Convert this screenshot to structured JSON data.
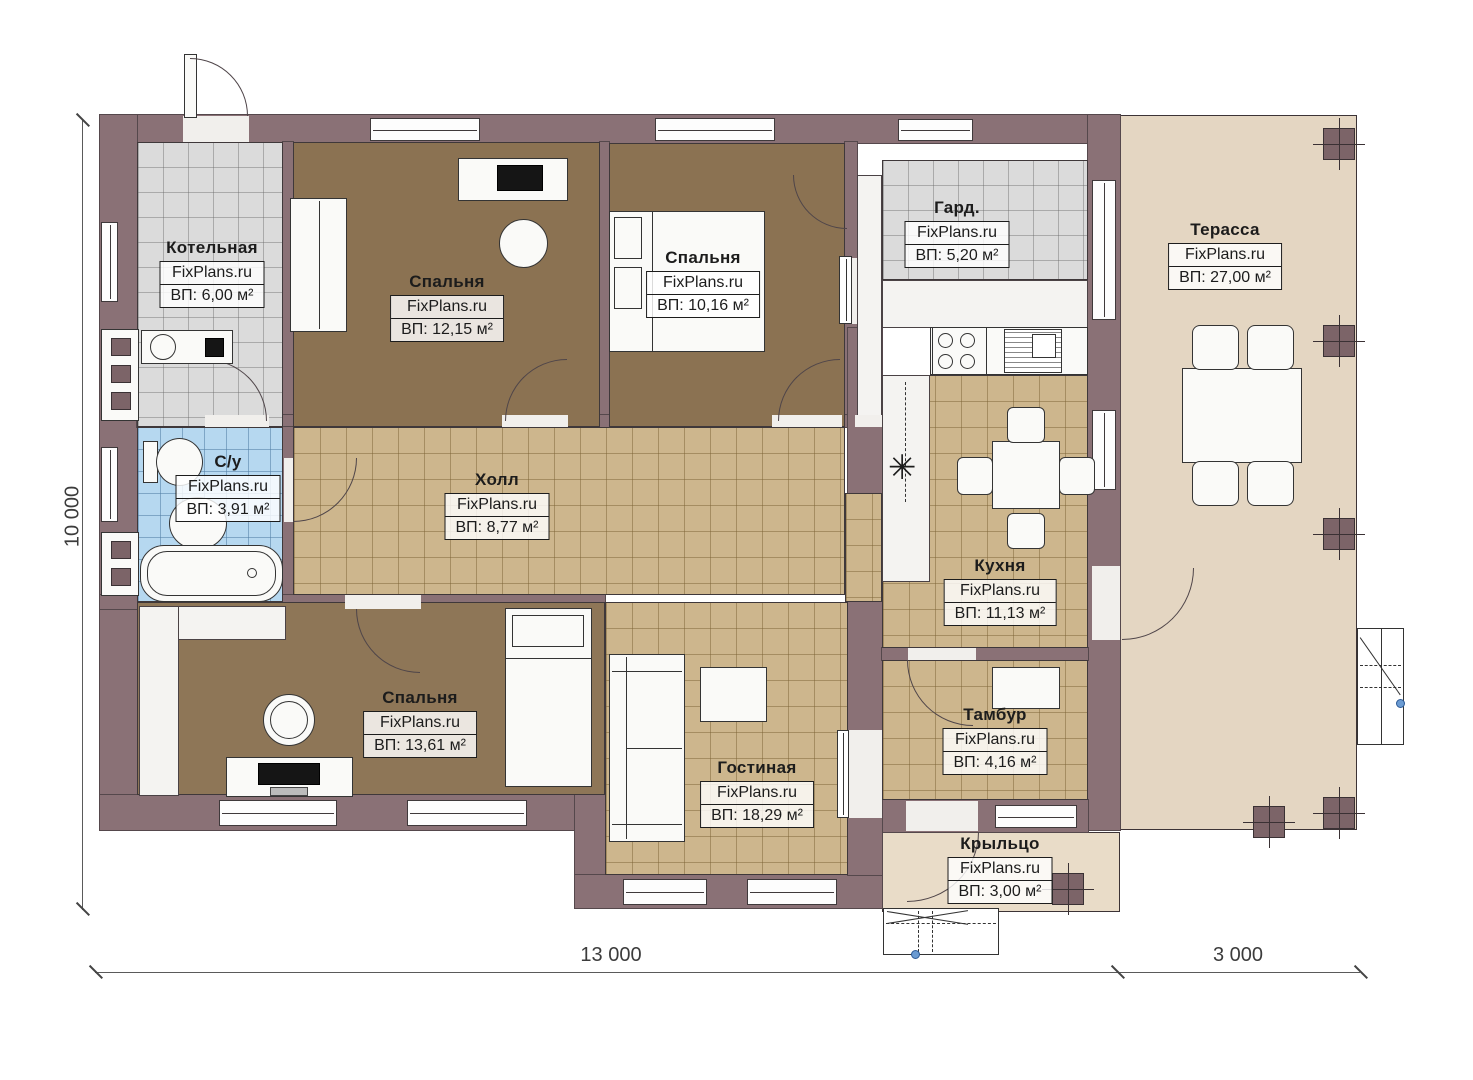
{
  "watermark": "FixPlans.ru",
  "rooms": [
    {
      "name": "Котельная",
      "area": "ВП: 6,00 м²"
    },
    {
      "name": "Спальня",
      "area": "ВП: 12,15 м²"
    },
    {
      "name": "Спальня",
      "area": "ВП: 10,16 м²"
    },
    {
      "name": "Гард.",
      "area": "ВП: 5,20 м²"
    },
    {
      "name": "Терасса",
      "area": "ВП: 27,00 м²"
    },
    {
      "name": "С/у",
      "area": "ВП: 3,91 м²"
    },
    {
      "name": "Холл",
      "area": "ВП: 8,77 м²"
    },
    {
      "name": "Кухня",
      "area": "ВП: 11,13 м²"
    },
    {
      "name": "Спальня",
      "area": "ВП: 13,61 м²"
    },
    {
      "name": "Гостиная",
      "area": "ВП: 18,29 м²"
    },
    {
      "name": "Тамбур",
      "area": "ВП: 4,16 м²"
    },
    {
      "name": "Крыльцо",
      "area": "ВП: 3,00 м²"
    }
  ],
  "dimensions": {
    "left": "10 000",
    "bottom_main": "13 000",
    "bottom_right": "3 000"
  },
  "symbols": {
    "fridge_marker": "✳"
  },
  "colors": {
    "wall": "#8a7176",
    "bedroom_floor": "#8b7252",
    "tile_floor": "#cdb68d",
    "terrace": "#e4d6c2",
    "bathroom_tile": "#b6d8f0",
    "utility_tile": "#dbdbdb"
  }
}
